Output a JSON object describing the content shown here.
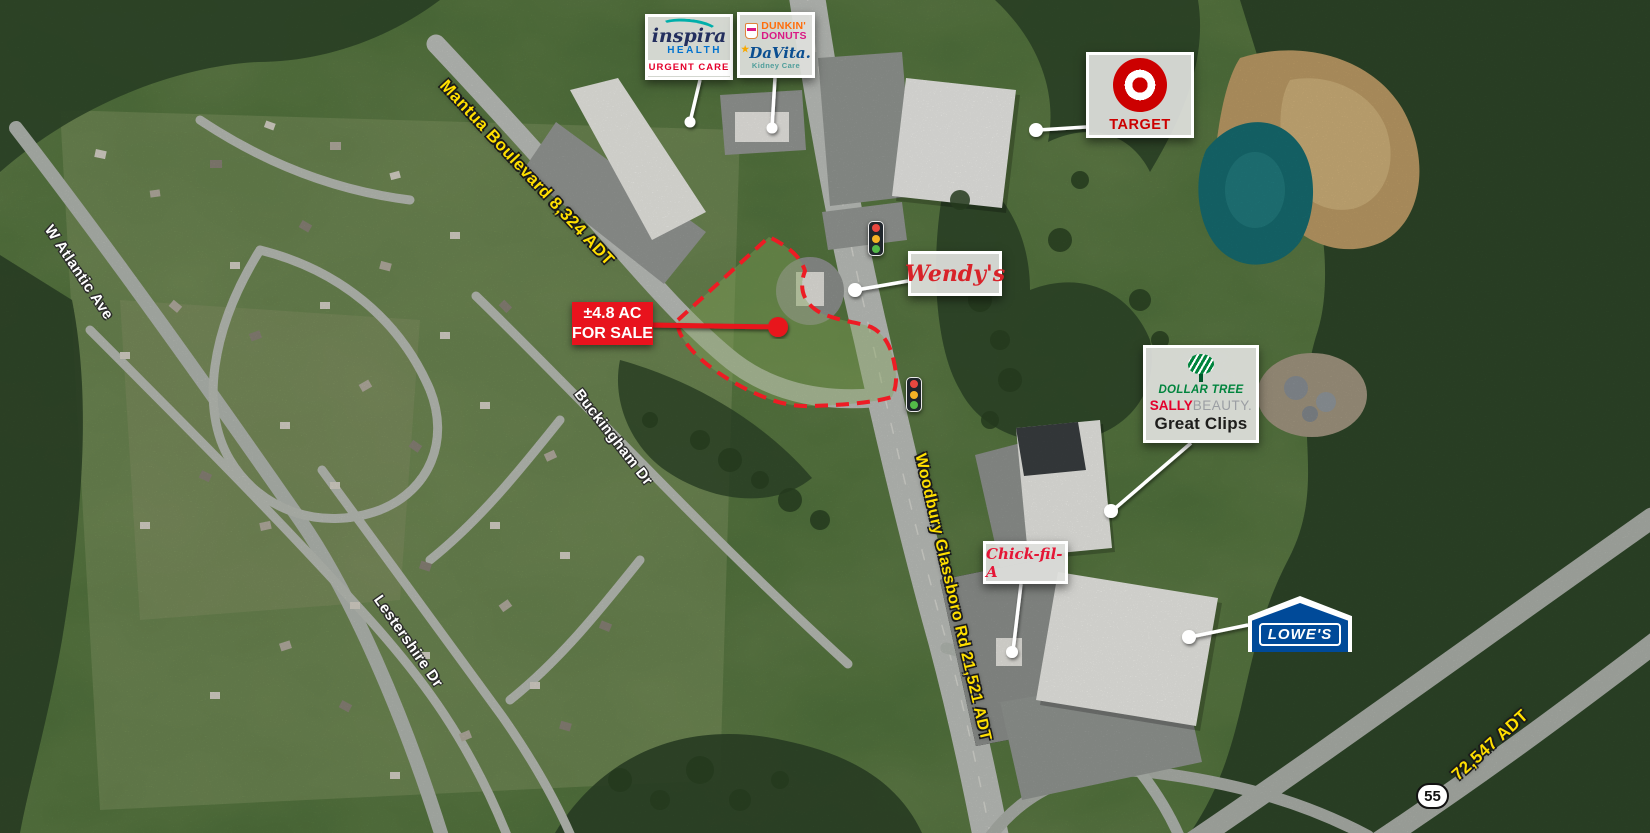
{
  "sale_callout": {
    "line1": "±4.8 AC",
    "line2": "FOR SALE",
    "bg_color": "#E8131D",
    "text_color": "#FFFFFF"
  },
  "road_labels": {
    "mantua": "Mantua Boulevard 8,324 ADT",
    "woodbury": "Woodbury Glassboro Rd 21,521 ADT",
    "route55_adt": "72,547 ADT",
    "color": "#FFDF00"
  },
  "street_labels": {
    "atlantic": "W Atlantic Ave",
    "buckingham": "Buckingham Dr",
    "lestershire": "Lestershire Dr"
  },
  "route_shield": {
    "number": "55"
  },
  "businesses": {
    "inspira": {
      "brand": "inspira",
      "sub": "HEALTH",
      "tag": "URGENT CARE"
    },
    "dunkin": {
      "line1": "DUNKIN'",
      "line2": "DONUTS"
    },
    "davita": {
      "brand": "DaVita.",
      "sub": "Kidney Care"
    },
    "target": {
      "name": "TARGET",
      "brand_color": "#CC0000"
    },
    "wendys": {
      "name": "Wendy's",
      "brand_color": "#D8232A"
    },
    "dollar_tree": {
      "name": "DOLLAR TREE",
      "brand_color": "#00843D"
    },
    "sally": {
      "part1": "SALLY",
      "part2": "BEAUTY."
    },
    "great_clips": {
      "name": "Great Clips"
    },
    "chick_fil_a": {
      "name": "Chick-fil-A",
      "brand_color": "#E51636"
    },
    "lowes": {
      "name": "LOWE'S",
      "brand_color": "#004A99"
    }
  },
  "icons": {
    "traffic_light": "traffic-light-icon",
    "target_logo": "bullseye-icon",
    "dollar_tree_logo": "striped-tree-icon",
    "dunkin_logo": "coffee-cup-icon",
    "lowes_logo": "house-gable-icon",
    "parcel": "red-dashed-parcel-outline"
  }
}
